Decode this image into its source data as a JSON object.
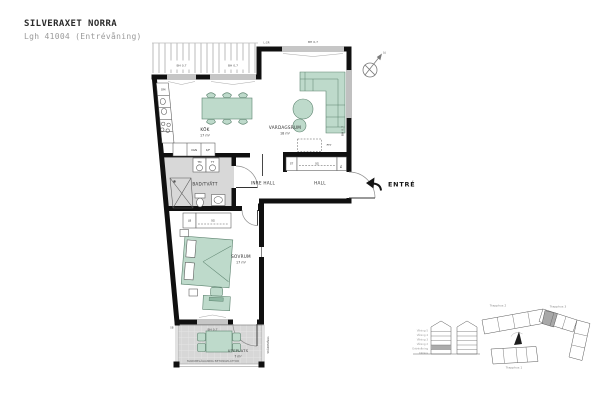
{
  "meta": {
    "title": "SILVERAXET NORRA",
    "subtitle": "Lgh 41004 (Entrévåning)"
  },
  "rooms": {
    "kok": {
      "label": "KÖK",
      "area": "17 m²"
    },
    "vardagsrum": {
      "label": "VARDAGSRUM",
      "area": "18 m²"
    },
    "badtvatt": {
      "label": "BAD/TVÄTT"
    },
    "inre_hall": {
      "label": "INRE HALL"
    },
    "hall": {
      "label": "HALL"
    },
    "sovrum": {
      "label": "SOVRUM",
      "area": "17 m²"
    },
    "uteplats": {
      "label": "UTEPLATS",
      "area": "7 m²"
    }
  },
  "labels": {
    "entre": "ENTRÉ",
    "dm": "DM",
    "ugn": "UGN",
    "kf": "K/F",
    "tm": "TM",
    "tt": "TT",
    "lb": "LB",
    "sg_bedroom": "SG",
    "st": "ST",
    "sg_hall": "SG",
    "el": "EL",
    "fty": "FTY",
    "sb": "SB",
    "bh07": "BH 0,7",
    "lgr": "L:GR",
    "skarmvagg": "SKÄRMVÄGG",
    "ground_note": "MARKBELÄGGNING BETONGPLATTOR",
    "north": "N"
  },
  "site": {
    "trapphus1": "Trapphus 1",
    "trapphus2": "Trapphus 2",
    "trapphus3": "Trapphus 3",
    "floors": [
      "Våning 5",
      "Våning 4",
      "Våning 3",
      "Våning 2",
      "Entrévåning",
      "Källare"
    ]
  },
  "colors": {
    "wall": "#101010",
    "furniture": "#bedacb",
    "furniture_stroke": "#5d836f",
    "wet_floor": "#d8d8d8",
    "patio_floor": "#d7d7d7",
    "hatch": "#cfcfcf",
    "text": "#2f2f2f",
    "muted": "#9a9a9a"
  }
}
